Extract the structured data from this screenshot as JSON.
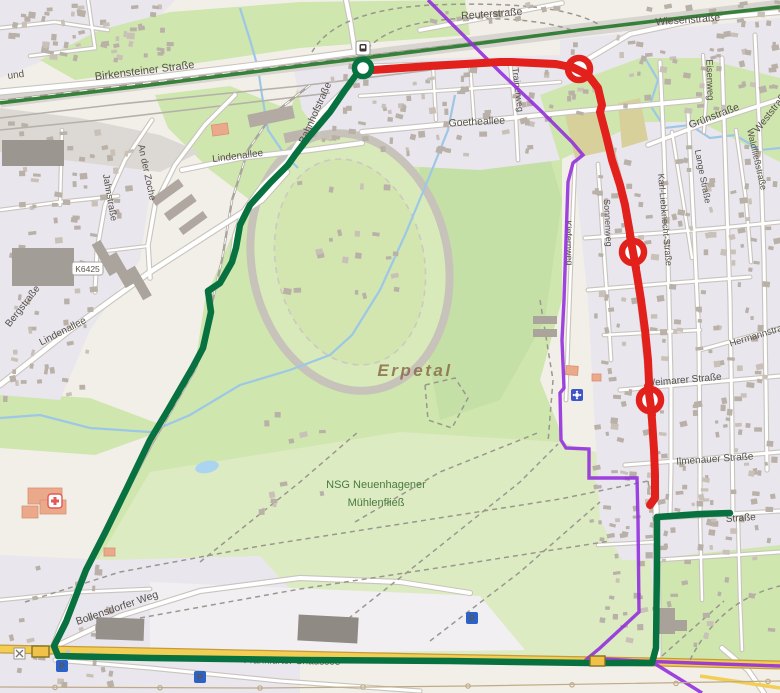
{
  "overlay": {
    "route_green_color": "#077140",
    "route_red_color": "#e2211c",
    "boundary_color": "#9330dd",
    "corridor_color": "#2e7d32"
  },
  "street_labels": [
    "und",
    "Birkensteiner Straße",
    "Reuterstraße",
    "Wiesenstraße",
    "Eisenweg",
    "Grünstraße",
    "Weststraße",
    "Waldfließstraße",
    "Lange Straße",
    "Karl-Liebknecht-Straße",
    "Sonnenweg",
    "Kiefernweg",
    "Trainerweg",
    "Goetheallee",
    "Bahnhofstraße",
    "Lindenallee",
    "Lindenallee",
    "Bergstraße",
    "An der Zoche",
    "Jahnstraße",
    "Bollensdorfer Weg",
    "Frankfurter Chaussee",
    "Weimarer Straße",
    "Ilmenauer Straße",
    "Hermannstraße",
    "Straße"
  ],
  "area_labels": {
    "valley": "Erpetal",
    "nsg_line1": "NSG Neuenhagener",
    "nsg_line2": "Mühlenfließ"
  },
  "road_refs": {
    "k6425": "K6425"
  },
  "icons": {
    "parking_letter": "P"
  }
}
